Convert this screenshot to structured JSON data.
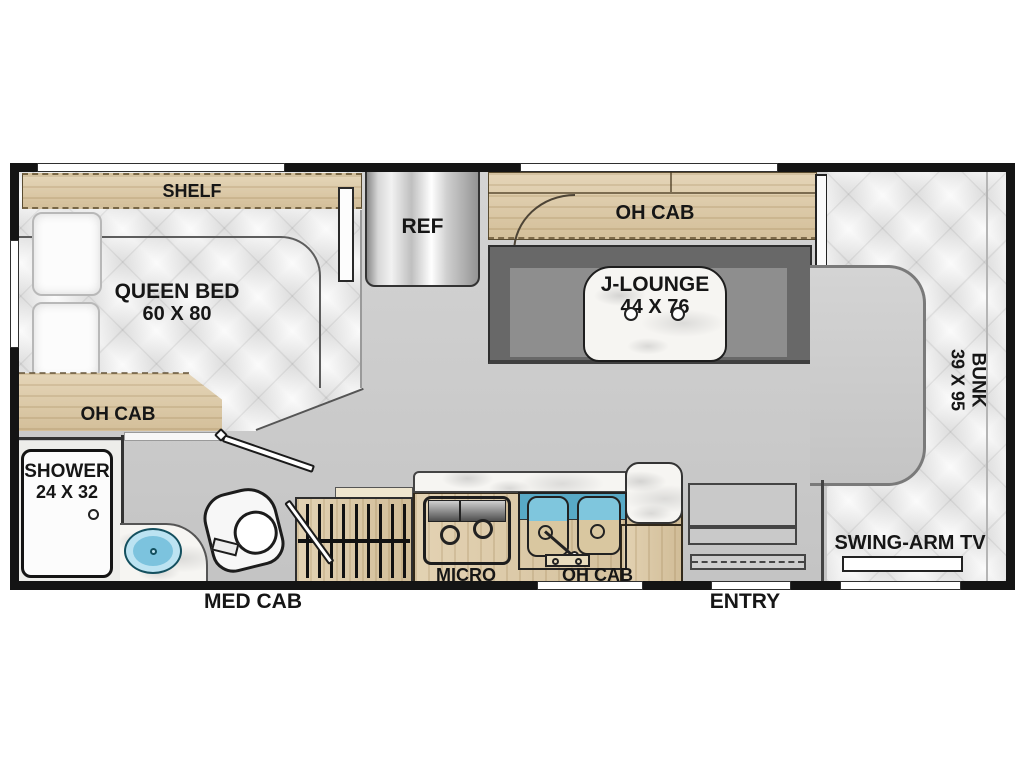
{
  "floorplan": {
    "title": "RV floor plan",
    "labels": {
      "shelf": "SHELF",
      "queen_bed": "QUEEN BED",
      "queen_bed_dims": "60 X 80",
      "oh_cab_bedroom": "OH CAB",
      "ref": "REF",
      "oh_cab_dinette": "OH CAB",
      "j_lounge": "J-LOUNGE",
      "j_lounge_dims": "44 X 76",
      "bunk": "BUNK",
      "bunk_dims": "39 X 95",
      "shower": "SHOWER",
      "shower_dims": "24 X 32",
      "med_cab": "MED CAB",
      "micro": "MICRO",
      "oh_cab_kitchen": "OH CAB",
      "swing_arm_tv": "SWING-ARM TV",
      "entry": "ENTRY"
    },
    "colors": {
      "wall": "#141414",
      "wood": "#DCC7A0",
      "floor": "#CDCDCD",
      "bench": "#686868",
      "bench_inner": "#8E8E8E",
      "quilt": "#FBFBFB",
      "marble": "#F6F5F2",
      "sink_band_blue": "#58A9C6",
      "sink_bowl_blue": "#7FC6DD",
      "basin_blue": "#7CC3DE",
      "fridge_silver": "#C9C9C9"
    }
  }
}
